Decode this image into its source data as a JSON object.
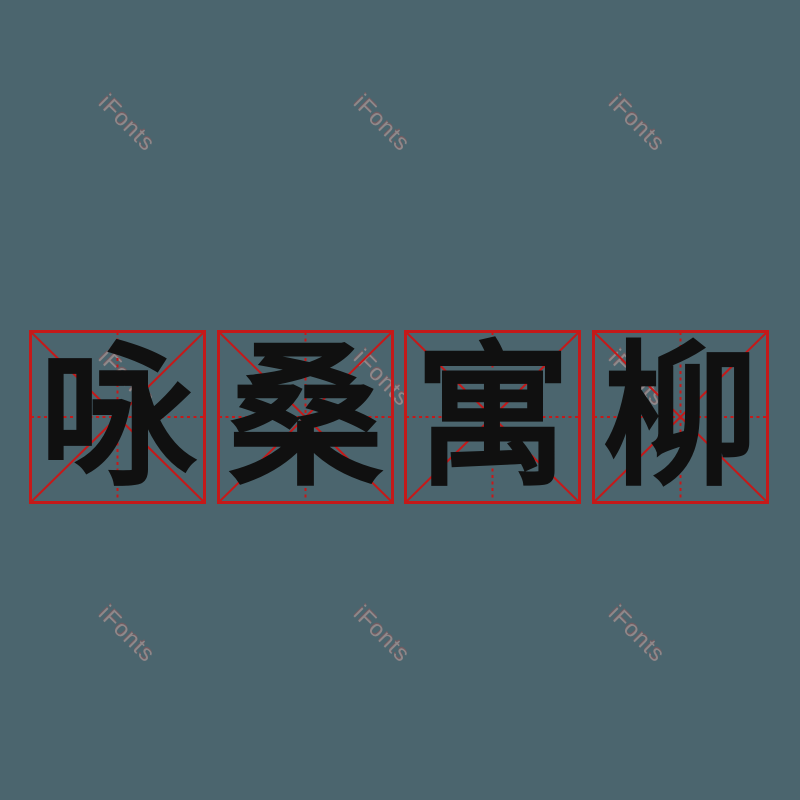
{
  "canvas": {
    "background": "#4b656e",
    "width": 800,
    "height": 800
  },
  "phrase": {
    "text": "咏桑寓柳",
    "ink_color": "#101010",
    "characters": [
      {
        "char": "咏"
      },
      {
        "char": "桑"
      },
      {
        "char": "寓"
      },
      {
        "char": "柳"
      }
    ]
  },
  "practice_grid": {
    "style": "mi-zi-ge",
    "line_color": "#c51919",
    "square_count": 4,
    "square_lefts": [
      29,
      217,
      404,
      592
    ],
    "square_top": 330,
    "square_width": 177,
    "square_height": 174
  },
  "watermark": {
    "text": "iFonts",
    "color": "#a39292",
    "rotation_deg": 45,
    "positions": [
      {
        "x": 127,
        "y": 123
      },
      {
        "x": 382,
        "y": 123
      },
      {
        "x": 637,
        "y": 123
      },
      {
        "x": 127,
        "y": 378
      },
      {
        "x": 382,
        "y": 378
      },
      {
        "x": 637,
        "y": 378
      },
      {
        "x": 127,
        "y": 634
      },
      {
        "x": 382,
        "y": 634
      },
      {
        "x": 637,
        "y": 634
      }
    ]
  }
}
